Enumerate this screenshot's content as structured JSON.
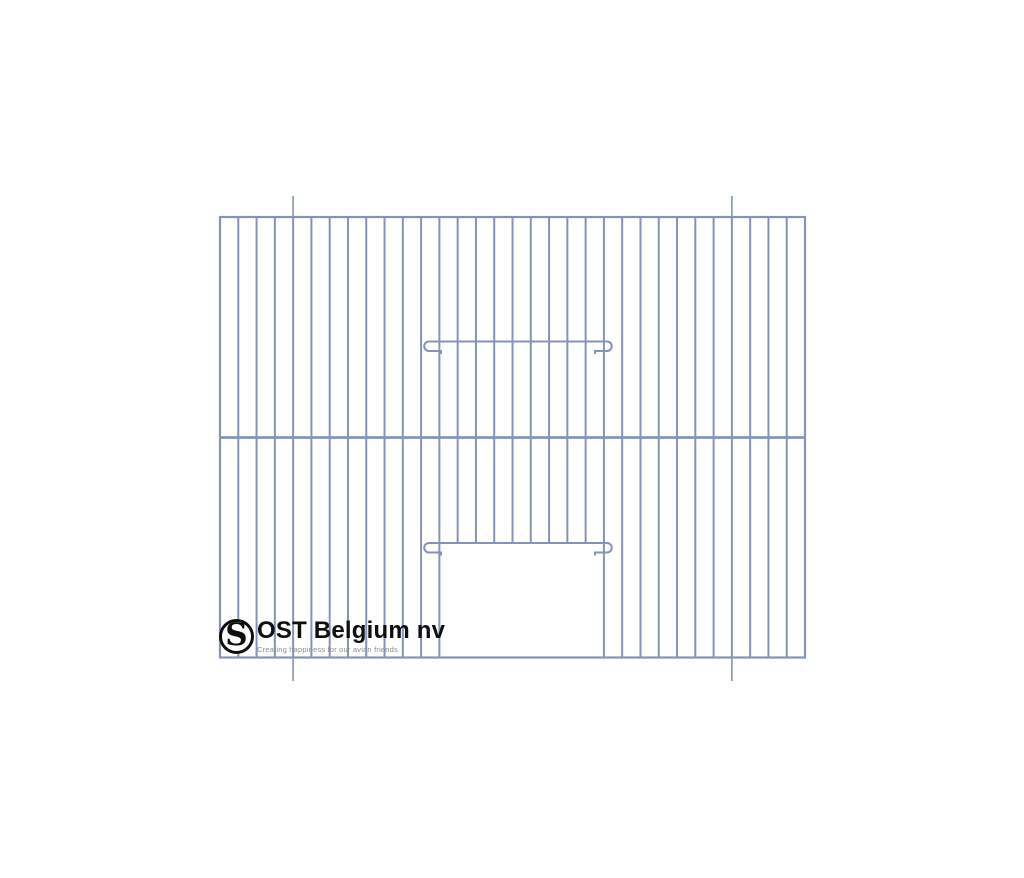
{
  "page": {
    "background": "#ffffff",
    "width": 1024,
    "height": 878
  },
  "logo": {
    "monogram": "S",
    "name": "OST Belgium nv",
    "tagline": "Creating happiness for our avian friends",
    "ring_color": "#0d0d0d",
    "name_color": "#0f0f0f",
    "tagline_color": "#8c8c8c"
  },
  "drawing": {
    "description": "cage front panel wire drawing",
    "wire_color": "#8494B8",
    "panel": {
      "left": 220,
      "top": 217,
      "right": 805,
      "bottom": 657.5
    },
    "bar_count": 33,
    "bar_width": 2,
    "frame_width": 2.2,
    "divider_y": 437.5,
    "divider_width": 2.8,
    "door": {
      "first_open_bar": 13,
      "last_open_bar": 20,
      "rail_y_upper": 341.5,
      "rail_y_lower": 543,
      "rail_x1": 429,
      "rail_x2": 607,
      "hook_radius": 4.75,
      "hook_return": 12,
      "hook_tick": 3
    },
    "ticks": {
      "xs": [
        293.1,
        731.9
      ],
      "top_y1": 196,
      "top_y2": 217,
      "bottom_y1": 657.5,
      "bottom_y2": 681,
      "width": 1.6
    }
  }
}
